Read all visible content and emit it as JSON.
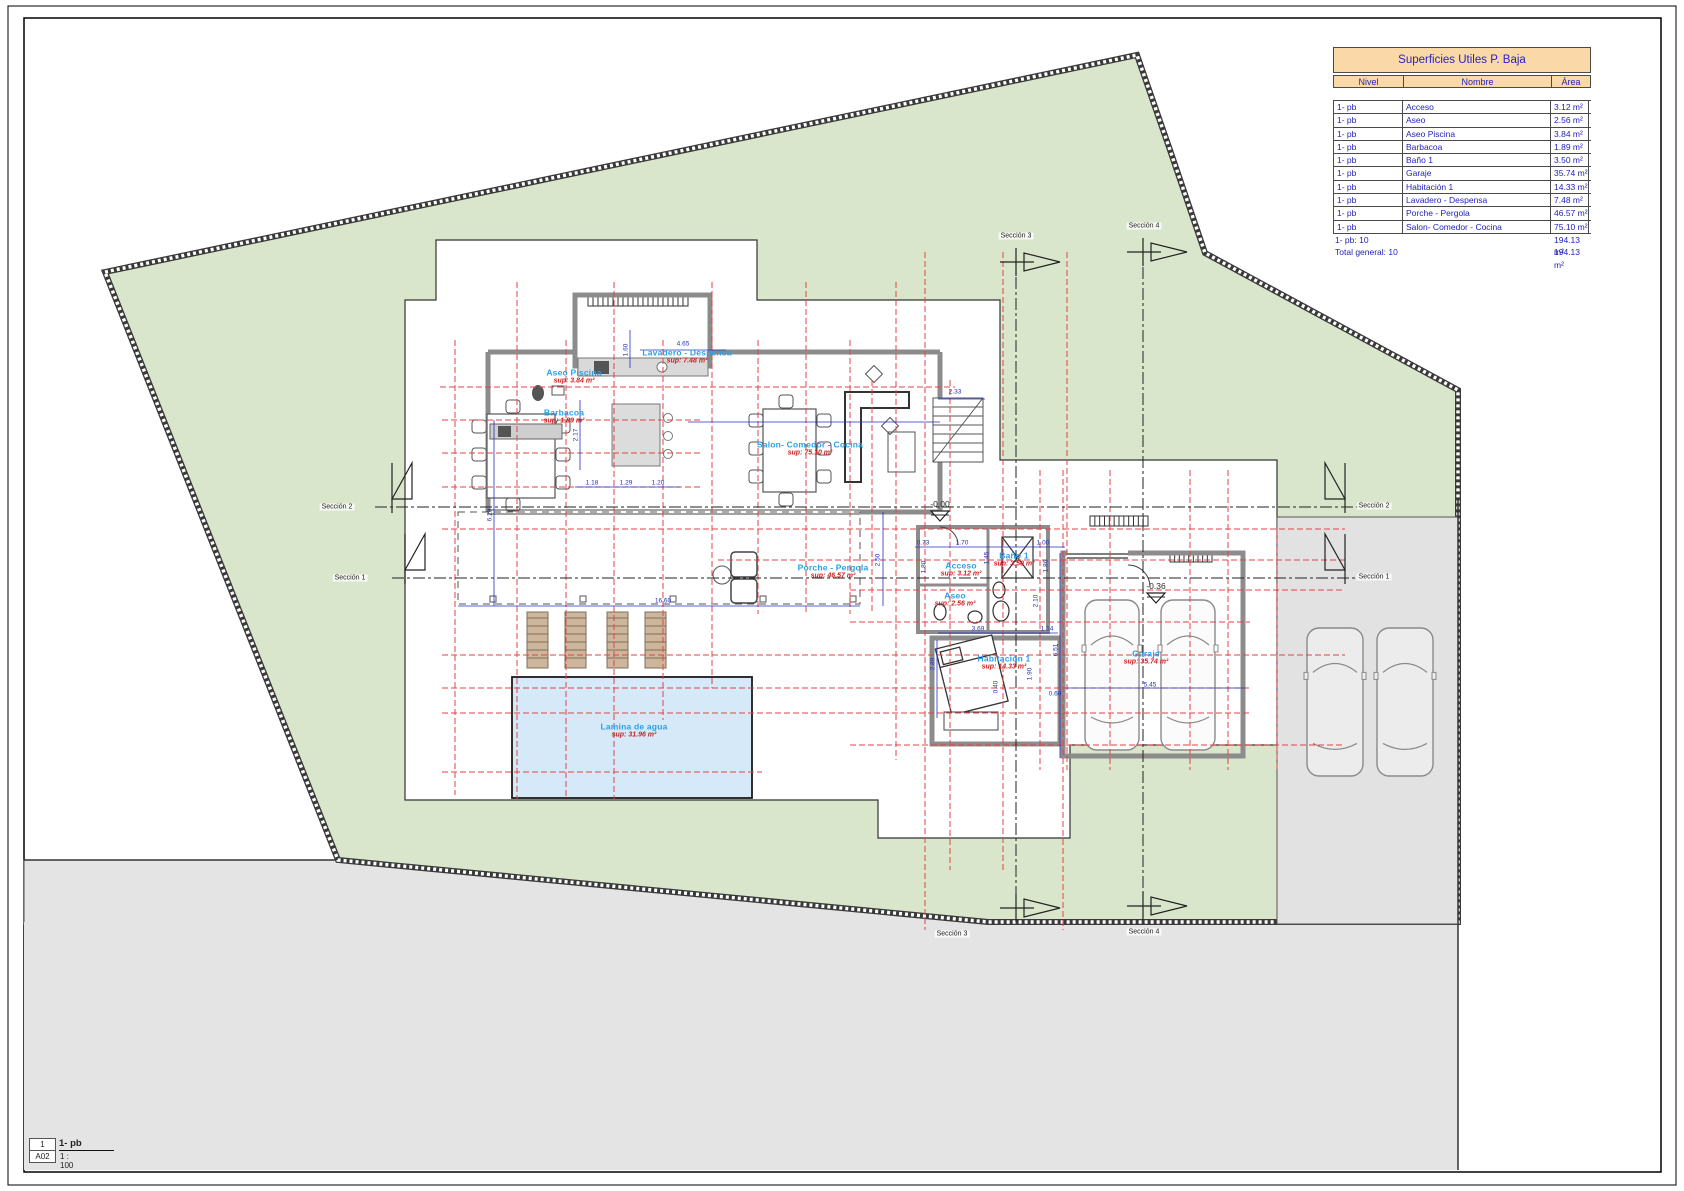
{
  "drawing": {
    "title_block": {
      "detail_number": "1",
      "sheet_code": "A02",
      "view_name": "1- pb",
      "scale": "1 : 100"
    },
    "area_table": {
      "title": "Superficies Utiles P. Baja",
      "columns": [
        "Nivel",
        "Nombre",
        "Área"
      ],
      "rows": [
        [
          "1- pb",
          "Acceso",
          "3.12 m²"
        ],
        [
          "1- pb",
          "Aseo",
          "2.56 m²"
        ],
        [
          "1- pb",
          "Aseo Piscina",
          "3.84 m²"
        ],
        [
          "1- pb",
          "Barbacoa",
          "1.89 m²"
        ],
        [
          "1- pb",
          "Baño 1",
          "3.50 m²"
        ],
        [
          "1- pb",
          "Garaje",
          "35.74 m²"
        ],
        [
          "1- pb",
          "Habitación 1",
          "14.33 m²"
        ],
        [
          "1- pb",
          "Lavadero - Despensa",
          "7.48 m²"
        ],
        [
          "1- pb",
          "Porche - Pergola",
          "46.57 m²"
        ],
        [
          "1- pb",
          "Salon- Comedor - Cocina",
          "75.10 m²"
        ]
      ],
      "subtotal": {
        "label": "1- pb: 10",
        "value": "194.13 m²"
      },
      "total": {
        "label": "Total general: 10",
        "value": "194.13 m²"
      }
    },
    "rooms": [
      {
        "name": "Aseo Piscina",
        "sup": "sup: 3.84 m²",
        "x": 574,
        "y": 377
      },
      {
        "name": "Barbacoa",
        "sup": "sup: 1.89 m²",
        "x": 564,
        "y": 417
      },
      {
        "name": "Lavadero - Despensa",
        "sup": "sup: 7.48 m²",
        "x": 687,
        "y": 357
      },
      {
        "name": "Salon- Comedor - Cocina",
        "sup": "sup: 75.10 m²",
        "x": 810,
        "y": 449
      },
      {
        "name": "Porche - Pergola",
        "sup": "sup: 46.57 m²",
        "x": 833,
        "y": 572
      },
      {
        "name": "Acceso",
        "sup": "sup: 3.12 m²",
        "x": 961,
        "y": 570
      },
      {
        "name": "Baño 1",
        "sup": "sup: 3.50 m²",
        "x": 1014,
        "y": 560
      },
      {
        "name": "Aseo",
        "sup": "sup: 2.56 m²",
        "x": 955,
        "y": 600
      },
      {
        "name": "Habitación 1",
        "sup": "sup: 14.33 m²",
        "x": 1004,
        "y": 663
      },
      {
        "name": "Garaje",
        "sup": "sup: 35.74 m²",
        "x": 1146,
        "y": 658
      },
      {
        "name": "Lamina de agua",
        "sup": "sup: 31.96 m²",
        "x": 634,
        "y": 731
      }
    ],
    "dimensions": [
      {
        "t": "4.65",
        "x": 683,
        "y": 344,
        "r": 0
      },
      {
        "t": "1.60",
        "x": 626,
        "y": 350,
        "r": 90
      },
      {
        "t": "2.17",
        "x": 576,
        "y": 435,
        "r": 90
      },
      {
        "t": "6.29",
        "x": 490,
        "y": 515,
        "r": 90
      },
      {
        "t": "1.18",
        "x": 592,
        "y": 483,
        "r": 0
      },
      {
        "t": "1.29",
        "x": 626,
        "y": 483,
        "r": 0
      },
      {
        "t": "1.20",
        "x": 658,
        "y": 483,
        "r": 0
      },
      {
        "t": "2.33",
        "x": 955,
        "y": 392,
        "r": 0
      },
      {
        "t": "16.60",
        "x": 663,
        "y": 601,
        "r": 0
      },
      {
        "t": "2.50",
        "x": 878,
        "y": 560,
        "r": 90
      },
      {
        "t": "0.73",
        "x": 923,
        "y": 543,
        "r": 0
      },
      {
        "t": "1.70",
        "x": 962,
        "y": 543,
        "r": 0
      },
      {
        "t": "1.00",
        "x": 1043,
        "y": 543,
        "r": 0
      },
      {
        "t": "1.80",
        "x": 924,
        "y": 567,
        "r": 90
      },
      {
        "t": "1.45",
        "x": 987,
        "y": 558,
        "r": 90
      },
      {
        "t": "1.86",
        "x": 1046,
        "y": 566,
        "r": 90
      },
      {
        "t": "2.10",
        "x": 1036,
        "y": 601,
        "r": 90
      },
      {
        "t": "3.69",
        "x": 978,
        "y": 629,
        "r": 0
      },
      {
        "t": "1.14",
        "x": 1047,
        "y": 629,
        "r": 0
      },
      {
        "t": "2.89",
        "x": 933,
        "y": 664,
        "r": 90
      },
      {
        "t": "1.90",
        "x": 1030,
        "y": 674,
        "r": 90
      },
      {
        "t": "0.60",
        "x": 1055,
        "y": 694,
        "r": 0
      },
      {
        "t": "0.40",
        "x": 996,
        "y": 687,
        "r": 90
      },
      {
        "t": "6.51",
        "x": 1056,
        "y": 650,
        "r": 90
      },
      {
        "t": "5.45",
        "x": 1150,
        "y": 685,
        "r": 0
      }
    ],
    "levels": [
      {
        "text": "-0.00",
        "x": 940,
        "y": 504
      },
      {
        "text": "-0.36",
        "x": 1156,
        "y": 586
      }
    ],
    "sections": {
      "s1": "Sección 1",
      "s2": "Sección 2",
      "s3": "Sección 3",
      "s4": "Sección 4"
    },
    "colors": {
      "site_green": "#d9e6cb",
      "street_gray": "#e4e4e4",
      "driveway_gray": "#e2e2e2",
      "pool_blue": "#d6e9f8",
      "grid_red": "#e04545",
      "dim_blue": "#2233bb",
      "room_blue": "#2e9fe6",
      "sup_red": "#cc2222",
      "table_header_bg": "#fbd8a8",
      "table_text": "#2222bb"
    }
  }
}
